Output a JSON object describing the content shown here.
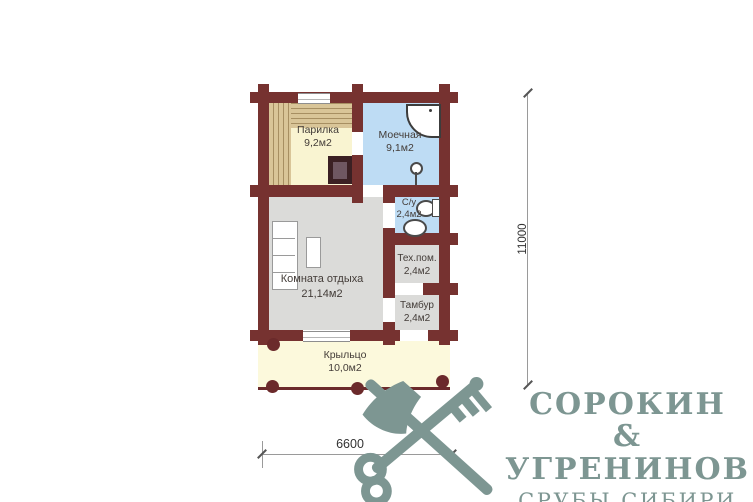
{
  "plan": {
    "rooms": [
      {
        "name": "Парилка",
        "area": "9,2м2"
      },
      {
        "name": "Моечная",
        "area": "9,1м2"
      },
      {
        "name": "С/у",
        "area": "2,4м2"
      },
      {
        "name": "Тех.пом.",
        "area": "2,4м2"
      },
      {
        "name": "Тамбур",
        "area": "2,4м2"
      },
      {
        "name": "Комната отдыха",
        "area": "21,14м2"
      },
      {
        "name": "Крыльцо",
        "area": "10,0м2"
      }
    ],
    "dimensions": {
      "height": "11000",
      "width": "6600"
    }
  },
  "branding": {
    "name_line1": "СОРОКИН &",
    "name_line2": "УГРЕНИНОВ",
    "tagline": "СРУБЫ СИБИРИ"
  },
  "colors": {
    "wall": "#763230",
    "sauna_floor": "#f9f4d1",
    "wet_floor": "#bedcf4",
    "room_floor": "#dbdbd9",
    "porch_floor": "#fcf9dc",
    "bench_wood": "#d9c598",
    "stove_dark": "#3b2023",
    "logo": "#7d9692"
  }
}
